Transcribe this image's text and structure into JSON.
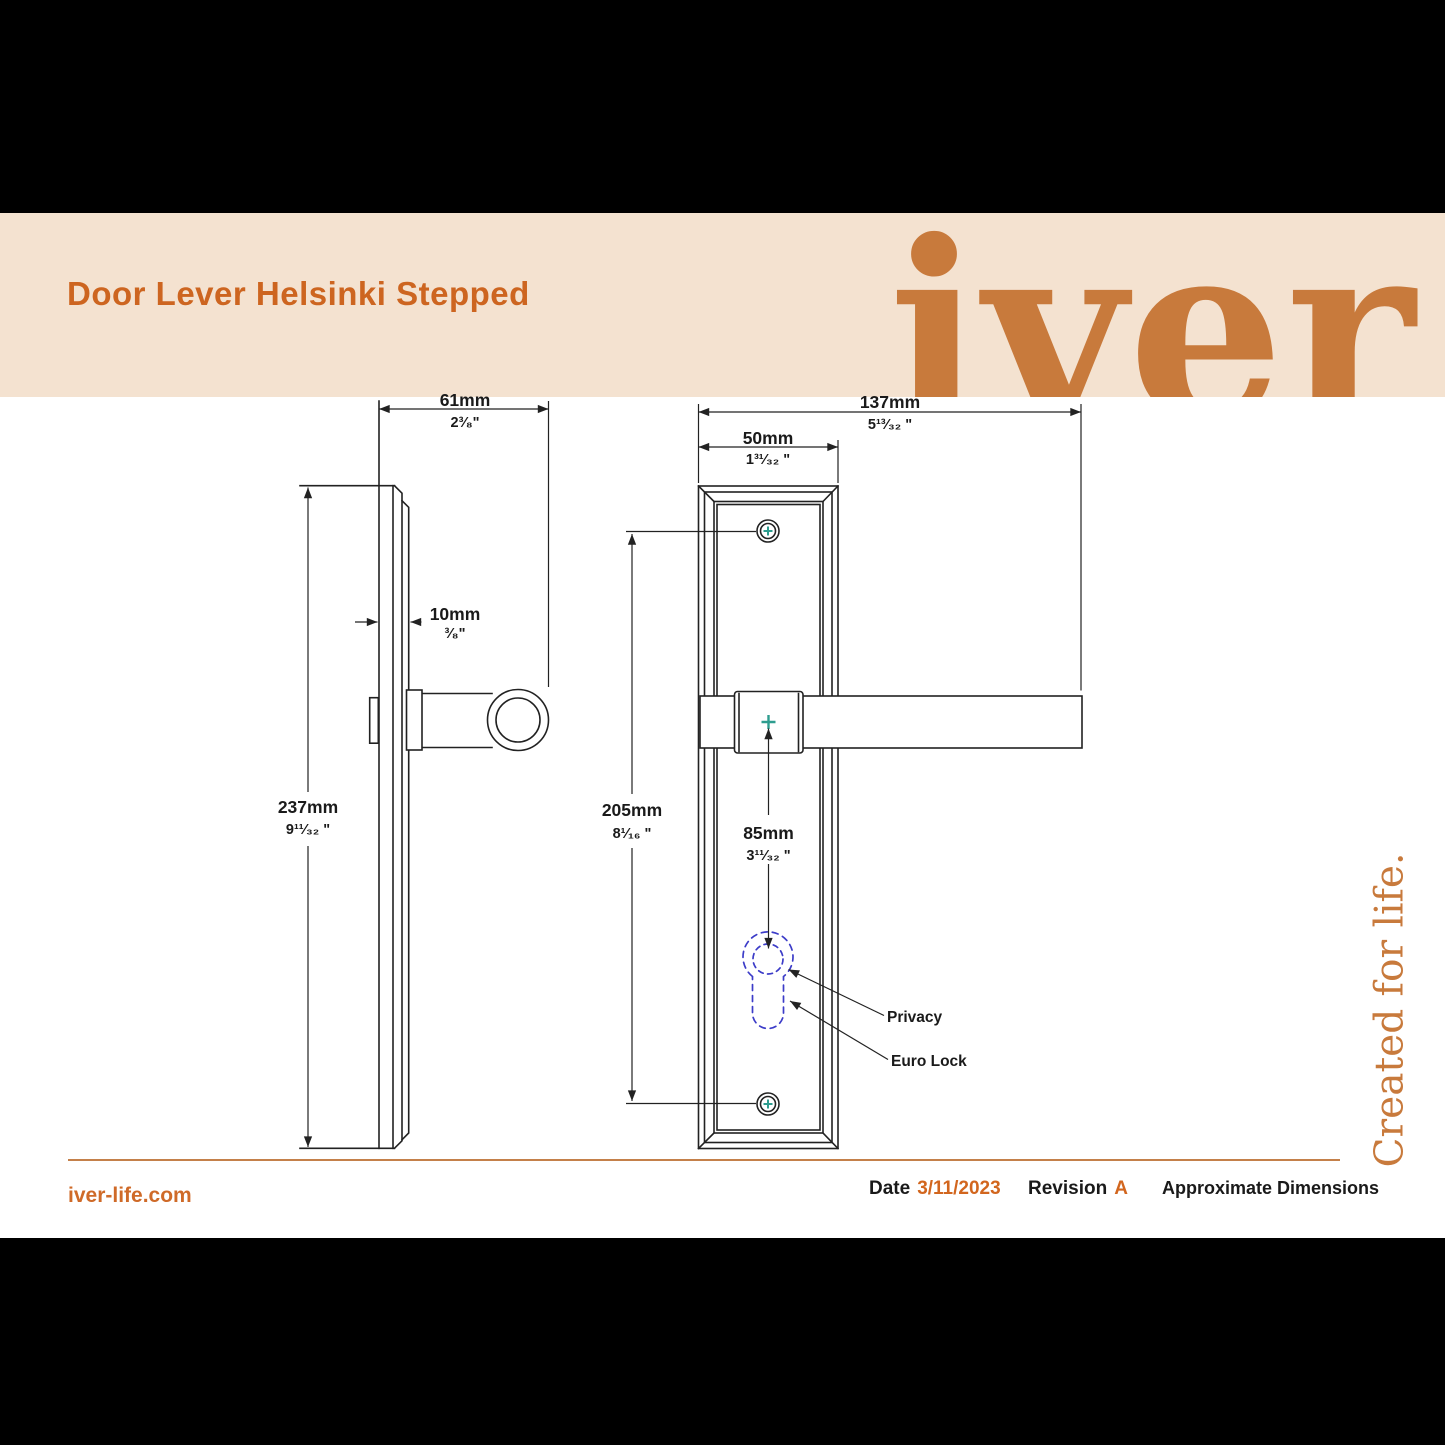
{
  "header": {
    "title": "Door Lever Helsinki Stepped",
    "brand": "iver",
    "band_color": "#f4e2d0",
    "title_color": "#cd6520",
    "logo_color": "#c87a3c"
  },
  "tagline": {
    "text": "Created for life."
  },
  "footer": {
    "website": "iver-life.com",
    "date_label": "Date",
    "date_value": "3/11/2023",
    "revision_label": "Revision",
    "revision_value": "A",
    "note": "Approximate Dimensions",
    "accent_orange": "#cf6a28",
    "rule_color": "#c4804a"
  },
  "drawing": {
    "description": "Door lever on stepped backplate — side elevation and front elevation with dimensions",
    "stroke_color": "#222222",
    "screw_cross_color": "#2e9d8f",
    "lock_outline_color": "#3c3cc8",
    "dims": {
      "side_projection": {
        "mm": "61mm",
        "in": "2³⁄₈\""
      },
      "plate_thickness": {
        "mm": "10mm",
        "in": "³⁄₈\""
      },
      "plate_height": {
        "mm": "237mm",
        "in": "9¹¹⁄₃₂ \""
      },
      "total_width": {
        "mm": "137mm",
        "in": "5¹³⁄₃₂ \""
      },
      "plate_width": {
        "mm": "50mm",
        "in": "1³¹⁄₃₂ \""
      },
      "fixing_centres": {
        "mm": "205mm",
        "in": "8¹⁄₁₆ \""
      },
      "lever_to_lock": {
        "mm": "85mm",
        "in": "3¹¹⁄₃₂ \""
      }
    },
    "callouts": {
      "privacy": "Privacy",
      "euro_lock": "Euro Lock"
    }
  }
}
